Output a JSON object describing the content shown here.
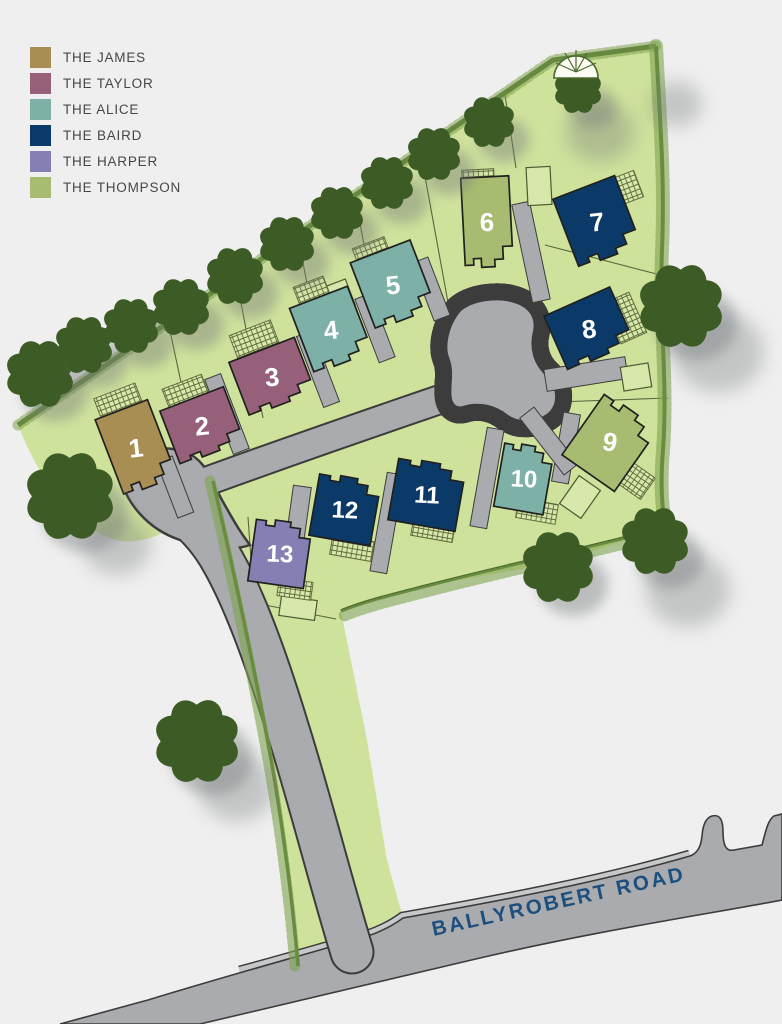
{
  "legend": {
    "items": [
      {
        "key": "james",
        "label": "THE JAMES",
        "color": "#a98e54"
      },
      {
        "key": "taylor",
        "label": "THE TAYLOR",
        "color": "#96607b"
      },
      {
        "key": "alice",
        "label": "THE ALICE",
        "color": "#7db0a7"
      },
      {
        "key": "baird",
        "label": "THE BAIRD",
        "color": "#0c3a68"
      },
      {
        "key": "harper",
        "label": "THE HARPER",
        "color": "#8480b4"
      },
      {
        "key": "thompson",
        "label": "THE THOMPSON",
        "color": "#a7bc70"
      }
    ]
  },
  "road": {
    "label": "BALLYROBERT ROAD"
  },
  "plots": [
    {
      "number": "1",
      "type": "THE JAMES",
      "type_key": "james"
    },
    {
      "number": "2",
      "type": "THE TAYLOR",
      "type_key": "taylor"
    },
    {
      "number": "3",
      "type": "THE TAYLOR",
      "type_key": "taylor"
    },
    {
      "number": "4",
      "type": "THE ALICE",
      "type_key": "alice"
    },
    {
      "number": "5",
      "type": "THE ALICE",
      "type_key": "alice"
    },
    {
      "number": "6",
      "type": "THE THOMPSON",
      "type_key": "thompson"
    },
    {
      "number": "7",
      "type": "THE BAIRD",
      "type_key": "baird"
    },
    {
      "number": "8",
      "type": "THE BAIRD",
      "type_key": "baird"
    },
    {
      "number": "9",
      "type": "THE THOMPSON",
      "type_key": "thompson"
    },
    {
      "number": "10",
      "type": "THE ALICE",
      "type_key": "alice"
    },
    {
      "number": "11",
      "type": "THE BAIRD",
      "type_key": "baird"
    },
    {
      "number": "12",
      "type": "THE BAIRD",
      "type_key": "baird"
    },
    {
      "number": "13",
      "type": "THE HARPER",
      "type_key": "harper"
    }
  ],
  "colors": {
    "background": "#efefef",
    "grass": "#cfe29c",
    "grass_light": "#d8e8ab",
    "road": "#a9abae",
    "road_light": "#c6c8ca",
    "road_outline": "#3c3c3c",
    "hedge": "#4c6a2d",
    "hedge_light": "#7ea34f",
    "tree": "#3d5b25",
    "house_outline": "#20201e",
    "plot_line": "#4b5a33",
    "hatch_line": "#606c3c",
    "road_label_color": "#1d4f7e",
    "legend_text": "#45474a",
    "number_color": "#ffffff"
  }
}
